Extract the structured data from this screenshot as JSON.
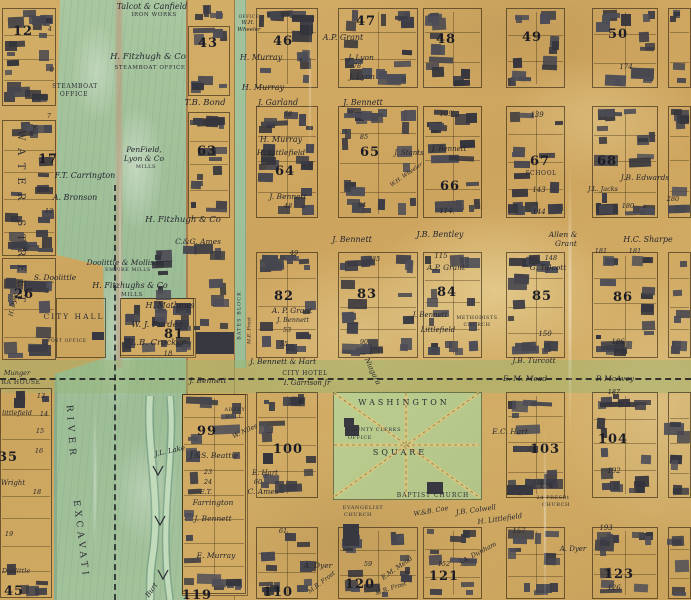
{
  "colors": {
    "parchment": "#d0a962",
    "water": "#a4c39c",
    "ink": "#23232b",
    "square_green": "#b9ca8d",
    "canal_green": "#9cb574",
    "shoreline": "#9b6444",
    "building": "#41414b"
  },
  "blocks": [
    {
      "n": "12",
      "x": 23,
      "y": 24
    },
    {
      "n": "17",
      "x": 48,
      "y": 152
    },
    {
      "n": "26",
      "x": 24,
      "y": 287
    },
    {
      "n": "35",
      "x": 8,
      "y": 450
    },
    {
      "n": "45",
      "x": 14,
      "y": 584
    },
    {
      "n": "43",
      "x": 208,
      "y": 36
    },
    {
      "n": "63",
      "x": 207,
      "y": 144
    },
    {
      "n": "81",
      "x": 174,
      "y": 327
    },
    {
      "n": "99",
      "x": 207,
      "y": 424
    },
    {
      "n": "119",
      "x": 197,
      "y": 588
    },
    {
      "n": "46",
      "x": 283,
      "y": 34
    },
    {
      "n": "47",
      "x": 366,
      "y": 14
    },
    {
      "n": "48",
      "x": 446,
      "y": 32
    },
    {
      "n": "49",
      "x": 532,
      "y": 30
    },
    {
      "n": "50",
      "x": 618,
      "y": 27
    },
    {
      "n": "64",
      "x": 285,
      "y": 164
    },
    {
      "n": "65",
      "x": 370,
      "y": 145
    },
    {
      "n": "66",
      "x": 450,
      "y": 179
    },
    {
      "n": "67",
      "x": 540,
      "y": 154
    },
    {
      "n": "68",
      "x": 607,
      "y": 154
    },
    {
      "n": "82",
      "x": 284,
      "y": 289
    },
    {
      "n": "83",
      "x": 367,
      "y": 287
    },
    {
      "n": "84",
      "x": 447,
      "y": 285
    },
    {
      "n": "85",
      "x": 542,
      "y": 289
    },
    {
      "n": "86",
      "x": 623,
      "y": 290
    },
    {
      "n": "100",
      "x": 288,
      "y": 442
    },
    {
      "n": "103",
      "x": 545,
      "y": 442
    },
    {
      "n": "104",
      "x": 613,
      "y": 432
    },
    {
      "n": "110",
      "x": 278,
      "y": 585
    },
    {
      "n": "120",
      "x": 360,
      "y": 577
    },
    {
      "n": "121",
      "x": 444,
      "y": 569
    },
    {
      "n": "123",
      "x": 619,
      "y": 567
    }
  ],
  "labels": [
    {
      "t": "Talcot & Canfield",
      "x": 152,
      "y": 3,
      "k": "n",
      "s": 8
    },
    {
      "t": "IRON WORKS",
      "x": 154,
      "y": 13,
      "k": "c",
      "s": 5.5
    },
    {
      "t": "H. Fitzhugh & Co",
      "x": 148,
      "y": 53,
      "k": "n",
      "s": 8.5
    },
    {
      "t": "STEAMBOAT OFFICE",
      "x": 150,
      "y": 66,
      "k": "c",
      "s": 5.5
    },
    {
      "t": "STEAMBOAT",
      "x": 75,
      "y": 84,
      "k": "c",
      "s": 6
    },
    {
      "t": "OFFICE",
      "x": 74,
      "y": 92,
      "k": "c",
      "s": 6
    },
    {
      "t": "WATER STREET",
      "x": 20,
      "y": 215,
      "k": "c",
      "s": 10,
      "r": 90,
      "sp": 8
    },
    {
      "t": "PenField,",
      "x": 144,
      "y": 146,
      "k": "n",
      "s": 7.5
    },
    {
      "t": "Lyon & Co",
      "x": 144,
      "y": 155,
      "k": "n",
      "s": 7.5
    },
    {
      "t": "MILLS",
      "x": 146,
      "y": 165,
      "k": "c",
      "s": 5
    },
    {
      "t": "F.T. Carrington",
      "x": 85,
      "y": 172,
      "k": "n",
      "s": 8
    },
    {
      "t": "A. Bronson",
      "x": 75,
      "y": 194,
      "k": "n",
      "s": 8
    },
    {
      "t": "S. Doolittle",
      "x": 55,
      "y": 274,
      "k": "n",
      "s": 7.5
    },
    {
      "t": "Doolittle & Mollison",
      "x": 125,
      "y": 259,
      "k": "n",
      "s": 7.5
    },
    {
      "t": "EMPIRE MILLS",
      "x": 128,
      "y": 269,
      "k": "c",
      "s": 4.8
    },
    {
      "t": "H. Fitzhughs & Co",
      "x": 130,
      "y": 282,
      "k": "n",
      "s": 8
    },
    {
      "t": "MILLS",
      "x": 132,
      "y": 293,
      "k": "c",
      "s": 5.5
    },
    {
      "t": "H. Fitzhugh & Co",
      "x": 183,
      "y": 216,
      "k": "n",
      "s": 8.5
    },
    {
      "t": "C.&G. Ames",
      "x": 198,
      "y": 238,
      "k": "n",
      "s": 7.5
    },
    {
      "t": "H. Mathews",
      "x": 170,
      "y": 302,
      "k": "n",
      "s": 8
    },
    {
      "t": "W. J. Purdee",
      "x": 157,
      "y": 321,
      "k": "n",
      "s": 8.5
    },
    {
      "t": "L.B. Crocker",
      "x": 158,
      "y": 339,
      "k": "n",
      "s": 8.5
    },
    {
      "t": "18",
      "x": 168,
      "y": 351,
      "k": "m",
      "s": 7
    },
    {
      "t": "T.B. Bond",
      "x": 205,
      "y": 99,
      "k": "n",
      "s": 8.5
    },
    {
      "t": "CITY HALL",
      "x": 74,
      "y": 313,
      "k": "c",
      "s": 7.5,
      "sp": 2
    },
    {
      "t": "POST OFFICE",
      "x": 67,
      "y": 340,
      "k": "c",
      "s": 4.5
    },
    {
      "t": "Munger",
      "x": 17,
      "y": 370,
      "k": "n",
      "s": 6.5
    },
    {
      "t": "RA HOUSE",
      "x": 21,
      "y": 380,
      "k": "c",
      "s": 6
    },
    {
      "t": "RIVER",
      "x": 70,
      "y": 428,
      "k": "c",
      "s": 9,
      "r": 86,
      "sp": 5
    },
    {
      "t": "EXCAVATI",
      "x": 80,
      "y": 535,
      "k": "c",
      "s": 9,
      "r": 83,
      "sp": 4
    },
    {
      "t": "J.L. Lake",
      "x": 170,
      "y": 448,
      "k": "n",
      "s": 7,
      "r": -12
    },
    {
      "t": "J.&S. Beattie",
      "x": 214,
      "y": 452,
      "k": "n",
      "s": 7.5
    },
    {
      "t": "Burt",
      "x": 152,
      "y": 587,
      "k": "n",
      "s": 7,
      "r": -55
    },
    {
      "t": "H. Dyer",
      "x": 14,
      "y": 302,
      "k": "n",
      "s": 6,
      "r": -78
    },
    {
      "t": "Wright",
      "x": 13,
      "y": 480,
      "k": "n",
      "s": 7
    },
    {
      "t": "littlefield",
      "x": 17,
      "y": 410,
      "k": "n",
      "s": 6.5
    },
    {
      "t": "Doolittle",
      "x": 16,
      "y": 568,
      "k": "n",
      "s": 6.5
    },
    {
      "t": "4",
      "x": 50,
      "y": 26,
      "k": "m",
      "s": 6.5
    },
    {
      "t": "9",
      "x": 52,
      "y": 67,
      "k": "m",
      "s": 6.5
    },
    {
      "t": "7",
      "x": 49,
      "y": 113,
      "k": "m",
      "s": 6.5
    },
    {
      "t": "12",
      "x": 49,
      "y": 208,
      "k": "m",
      "s": 6.5
    },
    {
      "t": "3",
      "x": 47,
      "y": 288,
      "k": "m",
      "s": 6.5
    },
    {
      "t": "13",
      "x": 41,
      "y": 393,
      "k": "m",
      "s": 6.5
    },
    {
      "t": "14",
      "x": 44,
      "y": 411,
      "k": "m",
      "s": 6.5
    },
    {
      "t": "15",
      "x": 40,
      "y": 428,
      "k": "m",
      "s": 6.5
    },
    {
      "t": "16",
      "x": 39,
      "y": 448,
      "k": "m",
      "s": 6.5
    },
    {
      "t": "18",
      "x": 37,
      "y": 489,
      "k": "m",
      "s": 6.5
    },
    {
      "t": "19",
      "x": 9,
      "y": 531,
      "k": "m",
      "s": 6.5
    },
    {
      "t": "OFFICE",
      "x": 249,
      "y": 15,
      "k": "c",
      "s": 4.2
    },
    {
      "t": "W.H.",
      "x": 248,
      "y": 21,
      "k": "n",
      "s": 5.5
    },
    {
      "t": "Wheeler",
      "x": 249,
      "y": 28,
      "k": "n",
      "s": 5.5
    },
    {
      "t": "H. Murray",
      "x": 261,
      "y": 54,
      "k": "n",
      "s": 8
    },
    {
      "t": "H. Murray",
      "x": 263,
      "y": 84,
      "k": "n",
      "s": 8
    },
    {
      "t": "A.P. Grant",
      "x": 343,
      "y": 34,
      "k": "n",
      "s": 8
    },
    {
      "t": "J. Lyon",
      "x": 361,
      "y": 54,
      "k": "n",
      "s": 7.5
    },
    {
      "t": "78",
      "x": 357,
      "y": 63,
      "k": "m",
      "s": 6.5
    },
    {
      "t": "J. Lyon",
      "x": 362,
      "y": 73,
      "k": "n",
      "s": 7.5
    },
    {
      "t": "174",
      "x": 626,
      "y": 64,
      "k": "m",
      "s": 7
    },
    {
      "t": "J. Garland",
      "x": 278,
      "y": 99,
      "k": "n",
      "s": 8
    },
    {
      "t": "58",
      "x": 288,
      "y": 111,
      "k": "m",
      "s": 6.5
    },
    {
      "t": "J. Bennett",
      "x": 363,
      "y": 99,
      "k": "n",
      "s": 8
    },
    {
      "t": "H. Murray",
      "x": 281,
      "y": 136,
      "k": "n",
      "s": 8
    },
    {
      "t": "H. Littlefield",
      "x": 281,
      "y": 149,
      "k": "n",
      "s": 7.5
    },
    {
      "t": "J. Bennett",
      "x": 288,
      "y": 193,
      "k": "n",
      "s": 7.5
    },
    {
      "t": "48",
      "x": 288,
      "y": 203,
      "k": "m",
      "s": 6.5
    },
    {
      "t": "85",
      "x": 364,
      "y": 134,
      "k": "m",
      "s": 6.5
    },
    {
      "t": "84",
      "x": 362,
      "y": 202,
      "k": "m",
      "s": 6.5
    },
    {
      "t": "109",
      "x": 446,
      "y": 111,
      "k": "m",
      "s": 7
    },
    {
      "t": "J. Bennett",
      "x": 449,
      "y": 146,
      "k": "n",
      "s": 7
    },
    {
      "t": "J. Stants",
      "x": 409,
      "y": 150,
      "k": "n",
      "s": 7
    },
    {
      "t": "W.H. Wheeler",
      "x": 407,
      "y": 173,
      "k": "n",
      "s": 5.5,
      "r": -35
    },
    {
      "t": "114",
      "x": 446,
      "y": 208,
      "k": "m",
      "s": 7
    },
    {
      "t": "139",
      "x": 537,
      "y": 112,
      "k": "m",
      "s": 7
    },
    {
      "t": "SCHOOL",
      "x": 541,
      "y": 171,
      "k": "c",
      "s": 6
    },
    {
      "t": "143",
      "x": 539,
      "y": 187,
      "k": "m",
      "s": 7
    },
    {
      "t": "144",
      "x": 539,
      "y": 209,
      "k": "m",
      "s": 7
    },
    {
      "t": "J.B. Edwards",
      "x": 645,
      "y": 174,
      "k": "n",
      "s": 7.5
    },
    {
      "t": "J.L. Jacks",
      "x": 603,
      "y": 186,
      "k": "n",
      "s": 6.5
    },
    {
      "t": "180",
      "x": 628,
      "y": 203,
      "k": "m",
      "s": 6.5
    },
    {
      "t": "280",
      "x": 673,
      "y": 196,
      "k": "m",
      "s": 6.5
    },
    {
      "t": "J. Bennett",
      "x": 352,
      "y": 236,
      "k": "n",
      "s": 8
    },
    {
      "t": "J.B. Bentley",
      "x": 440,
      "y": 231,
      "k": "n",
      "s": 8
    },
    {
      "t": "Allen &",
      "x": 563,
      "y": 231,
      "k": "n",
      "s": 7.5
    },
    {
      "t": "Grant",
      "x": 566,
      "y": 240,
      "k": "n",
      "s": 7.5
    },
    {
      "t": "H.C. Sharpe",
      "x": 648,
      "y": 236,
      "k": "n",
      "s": 8
    },
    {
      "t": "49",
      "x": 294,
      "y": 250,
      "k": "m",
      "s": 6.5
    },
    {
      "t": "85",
      "x": 376,
      "y": 256,
      "k": "m",
      "s": 6.5
    },
    {
      "t": "115",
      "x": 441,
      "y": 253,
      "k": "m",
      "s": 7
    },
    {
      "t": "A.P. Grant",
      "x": 446,
      "y": 264,
      "k": "n",
      "s": 7.5
    },
    {
      "t": "148",
      "x": 551,
      "y": 255,
      "k": "m",
      "s": 6.5
    },
    {
      "t": "G. Talcott",
      "x": 548,
      "y": 264,
      "k": "n",
      "s": 7.5
    },
    {
      "t": "181",
      "x": 601,
      "y": 248,
      "k": "m",
      "s": 6.5
    },
    {
      "t": "181",
      "x": 635,
      "y": 248,
      "k": "m",
      "s": 6.5
    },
    {
      "t": "A. P. Grant",
      "x": 292,
      "y": 307,
      "k": "n",
      "s": 7.5
    },
    {
      "t": "J. Bennett",
      "x": 293,
      "y": 317,
      "k": "n",
      "s": 6.5
    },
    {
      "t": "53",
      "x": 287,
      "y": 327,
      "k": "m",
      "s": 6.5
    },
    {
      "t": "55",
      "x": 284,
      "y": 341,
      "k": "m",
      "s": 6.5
    },
    {
      "t": "BATES BLOCK",
      "x": 240,
      "y": 313,
      "k": "c",
      "s": 5,
      "r": -90,
      "sp": 1
    },
    {
      "t": "M.E. Frost",
      "x": 250,
      "y": 328,
      "k": "n",
      "s": 5,
      "r": -90
    },
    {
      "t": "90",
      "x": 364,
      "y": 339,
      "k": "m",
      "s": 6.5
    },
    {
      "t": "J. Bennett",
      "x": 430,
      "y": 312,
      "k": "n",
      "s": 7
    },
    {
      "t": "Littlefield",
      "x": 438,
      "y": 327,
      "k": "n",
      "s": 7
    },
    {
      "t": "METHODISTS",
      "x": 477,
      "y": 317,
      "k": "c",
      "s": 4.8
    },
    {
      "t": "CHURCH",
      "x": 477,
      "y": 324,
      "k": "c",
      "s": 4.8
    },
    {
      "t": "150",
      "x": 545,
      "y": 331,
      "k": "m",
      "s": 7
    },
    {
      "t": "186",
      "x": 618,
      "y": 339,
      "k": "m",
      "s": 7
    },
    {
      "t": "J. Bennett & Hart",
      "x": 283,
      "y": 358,
      "k": "n",
      "s": 7.5
    },
    {
      "t": "CITY HOTEL",
      "x": 305,
      "y": 371,
      "k": "c",
      "s": 6
    },
    {
      "t": "I. Garrison Jr",
      "x": 307,
      "y": 380,
      "k": "n",
      "s": 7
    },
    {
      "t": "Niagara",
      "x": 372,
      "y": 368,
      "k": "n",
      "s": 7,
      "r": 65
    },
    {
      "t": "J.B. Turcott",
      "x": 534,
      "y": 357,
      "k": "n",
      "s": 7.5
    },
    {
      "t": "J. Bennett",
      "x": 208,
      "y": 377,
      "k": "n",
      "s": 7.5
    },
    {
      "t": "E. M. Mead",
      "x": 525,
      "y": 375,
      "k": "n",
      "s": 7.5
    },
    {
      "t": "P. McAvoy",
      "x": 615,
      "y": 375,
      "k": "n",
      "s": 7.5
    },
    {
      "t": "187",
      "x": 614,
      "y": 389,
      "k": "m",
      "s": 6.5
    },
    {
      "t": "WASHINGTON",
      "x": 404,
      "y": 399,
      "k": "c",
      "s": 8,
      "sp": 3
    },
    {
      "t": "COUNTY CLERKS",
      "x": 374,
      "y": 428,
      "k": "c",
      "s": 5
    },
    {
      "t": "OFFICE",
      "x": 360,
      "y": 436,
      "k": "c",
      "s": 5
    },
    {
      "t": "SQUARE",
      "x": 400,
      "y": 449,
      "k": "c",
      "s": 8,
      "sp": 3
    },
    {
      "t": "E.C. Hart",
      "x": 510,
      "y": 428,
      "k": "n",
      "s": 7.5
    },
    {
      "t": "156",
      "x": 546,
      "y": 483,
      "k": "m",
      "s": 7
    },
    {
      "t": "192",
      "x": 614,
      "y": 468,
      "k": "m",
      "s": 7
    },
    {
      "t": "ABBEY",
      "x": 235,
      "y": 408,
      "k": "c",
      "s": 5
    },
    {
      "t": "HALL",
      "x": 234,
      "y": 415,
      "k": "c",
      "s": 5
    },
    {
      "t": "W. Niles",
      "x": 245,
      "y": 428,
      "k": "n",
      "s": 6.5,
      "r": -25
    },
    {
      "t": "55-6",
      "x": 296,
      "y": 399,
      "k": "m",
      "s": 7
    },
    {
      "t": "E. Hart",
      "x": 265,
      "y": 470,
      "k": "n",
      "s": 7
    },
    {
      "t": "60",
      "x": 258,
      "y": 479,
      "k": "m",
      "s": 6.5
    },
    {
      "t": "C. Ames",
      "x": 263,
      "y": 488,
      "k": "n",
      "s": 7.5
    },
    {
      "t": "23",
      "x": 208,
      "y": 469,
      "k": "m",
      "s": 6.5
    },
    {
      "t": "24",
      "x": 208,
      "y": 479,
      "k": "m",
      "s": 6.5
    },
    {
      "t": "E.T.",
      "x": 206,
      "y": 489,
      "k": "n",
      "s": 6.5
    },
    {
      "t": "Farrington",
      "x": 213,
      "y": 499,
      "k": "n",
      "s": 7.5
    },
    {
      "t": "J. Bennett",
      "x": 213,
      "y": 515,
      "k": "n",
      "s": 7.5
    },
    {
      "t": "E. Murray",
      "x": 216,
      "y": 552,
      "k": "n",
      "s": 7.5
    },
    {
      "t": "BAPTIST CHURCH",
      "x": 433,
      "y": 493,
      "k": "c",
      "s": 6,
      "sp": 1
    },
    {
      "t": "EVANGELIST",
      "x": 363,
      "y": 506,
      "k": "c",
      "s": 5
    },
    {
      "t": "CHURCH",
      "x": 358,
      "y": 513,
      "k": "c",
      "s": 5
    },
    {
      "t": "W.&B. Coe",
      "x": 431,
      "y": 508,
      "k": "n",
      "s": 6.5,
      "r": -10
    },
    {
      "t": "J.B. Colwell",
      "x": 476,
      "y": 507,
      "k": "n",
      "s": 7,
      "r": -8
    },
    {
      "t": "H. Littlefield",
      "x": 500,
      "y": 516,
      "k": "n",
      "s": 7,
      "r": -8
    },
    {
      "t": "2d PRESBt",
      "x": 553,
      "y": 496,
      "k": "c",
      "s": 5
    },
    {
      "t": "CHURCH",
      "x": 556,
      "y": 503,
      "k": "c",
      "s": 5
    },
    {
      "t": "61",
      "x": 283,
      "y": 528,
      "k": "m",
      "s": 6.5
    },
    {
      "t": "A. Dyer",
      "x": 318,
      "y": 562,
      "k": "n",
      "s": 7.5
    },
    {
      "t": "59",
      "x": 368,
      "y": 561,
      "k": "m",
      "s": 6.5
    },
    {
      "t": "E.M. Mead",
      "x": 397,
      "y": 565,
      "k": "n",
      "s": 6.5,
      "r": -35
    },
    {
      "t": "M.B. Frost",
      "x": 322,
      "y": 580,
      "k": "n",
      "s": 6,
      "r": -38
    },
    {
      "t": "M.R. Frost",
      "x": 391,
      "y": 586,
      "k": "n",
      "s": 6,
      "r": -18
    },
    {
      "t": "157",
      "x": 519,
      "y": 528,
      "k": "m",
      "s": 7
    },
    {
      "t": "A. Dyer",
      "x": 573,
      "y": 546,
      "k": "n",
      "s": 7
    },
    {
      "t": "193",
      "x": 606,
      "y": 525,
      "k": "m",
      "s": 7
    },
    {
      "t": "126",
      "x": 614,
      "y": 585,
      "k": "m",
      "s": 7
    },
    {
      "t": "J.A. Dunham",
      "x": 478,
      "y": 550,
      "k": "n",
      "s": 6.5,
      "r": -28
    },
    {
      "t": "152",
      "x": 444,
      "y": 561,
      "k": "m",
      "s": 6.5
    }
  ]
}
